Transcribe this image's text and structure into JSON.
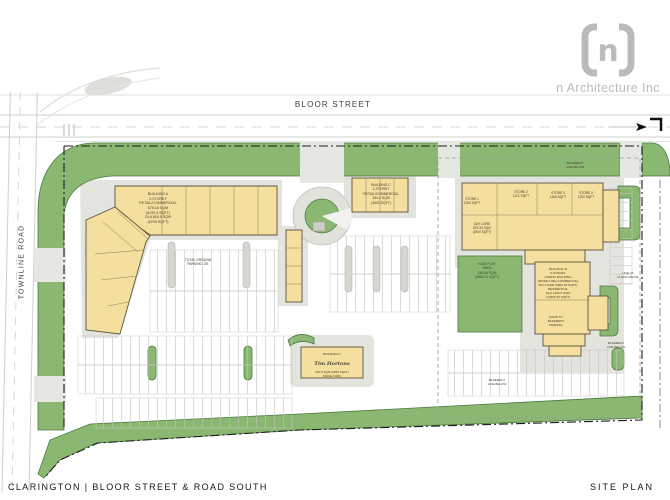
{
  "brand": {
    "symbol": "n",
    "name": "n Architecture Inc"
  },
  "roads": {
    "north": "BLOOR STREET",
    "west": "TOWNLINE ROAD"
  },
  "titleblock": {
    "project": "CLARINGTON | BLOOR STREET & ROAD SOUTH",
    "sheet": "SITE PLAN"
  },
  "labels": {
    "building_a": "BUILDING A\n2-STOREY\nRETAIL/COMMERCIAL\n575.18 SQM\n(6190.5 SQFT)\nGLA 816.9 SQM\n(8793 SQFT)",
    "building_c": "BUILDING C\n1-STOREY\nRETAIL/COMMERCIAL\n334.4 SQM\n(3600 SQFT)",
    "store_1": "STORE 1\n1200 SQFT",
    "store_2": "STORE 2\n1121 SQFT",
    "store_3": "STORE 3\n1165 SQFT",
    "store_4": "STORE 4\n1200 SQFT",
    "day_care": "DAY CARE\n876.33 SQM\n(2500 SQFT)",
    "kids_play": "KIDS PLAY\nAREA\n246.66 SQM\n(2656.01 SQFT)",
    "building_b": "BUILDING B\n6-STOREY\nCONDO BUILDING\n(MIXED USE) COMMERCIAL\n563.3 SQM (6063.33 SQFT)\nRESIDENTIAL\nGLA 1204.5 SQM\n(12965.33 SQFT)",
    "building_d_title": "BUILDING D",
    "building_d_brand": "Tim Hortons",
    "building_d_area": "265.9 SQM (2863 SQFT)\nDRIVE-THRU",
    "parking_total": "TOTAL GROUND\nPARKING 191",
    "basement_note": "BASEMENT\nLINE BELOW",
    "floor_above_note": "LINE OF\nFLOOR ABOVE",
    "ramp_note": "RAMP TO\nBASEMENT\nPARKING"
  },
  "colors": {
    "building_fill": "#f4df9e",
    "building_edge": "#5b5340",
    "landscape_green": "#8ab873",
    "landscape_edge": "#4c7a3f",
    "paving_gray": "#e4e4df",
    "road_line": "#cfcfcb",
    "boundary_black": "#1c1c1c",
    "logo_gray": "#b9bcbe"
  }
}
